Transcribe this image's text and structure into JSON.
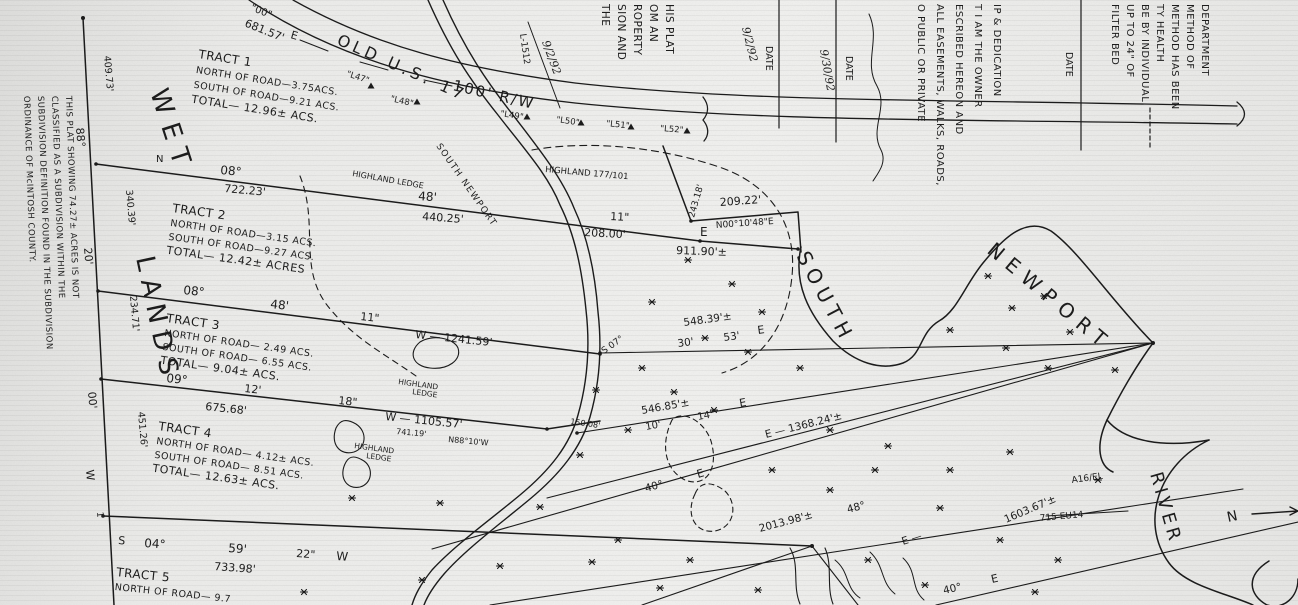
{
  "paper": {
    "ink_color": "#1b1b1b",
    "paper_color": "#ececea"
  },
  "road": {
    "name": "OLD U.S. 17",
    "right_of_way": "100' R/W"
  },
  "water": {
    "word_south": "SOUTH",
    "word_newport": "NEWPORT",
    "word_river": "RIVER"
  },
  "north_arrow_label": "N",
  "wetlands_label": {
    "word1": "WET",
    "word2": "LANDS"
  },
  "tracts": [
    {
      "lines": [
        "TRACT 1",
        "NORTH OF ROAD—3.75ACS.",
        "SOUTH OF ROAD—9.21 ACS.",
        "TOTAL— 12.96± ACS."
      ]
    },
    {
      "lines": [
        "TRACT 2",
        "NORTH OF ROAD—3.15 ACS.",
        "SOUTH OF ROAD—9.27 ACS.",
        "TOTAL— 12.42± ACRES"
      ]
    },
    {
      "lines": [
        "TRACT 3",
        "NORTH OF ROAD— 2.49 ACS.",
        "SOUTH OF ROAD— 6.55 ACS.",
        "TOTAL— 9.04± ACS."
      ]
    },
    {
      "lines": [
        "TRACT 4",
        "NORTH OF ROAD— 4.12± ACS.",
        "SOUTH OF ROAD— 8.51 ACS.",
        "TOTAL— 12.63± ACS."
      ]
    },
    {
      "lines": [
        "TRACT 5",
        "NORTH OF ROAD— 9.7"
      ]
    }
  ],
  "blocks": {
    "margin_note": {
      "lines": [
        "THIS PLAT SHOWING 74.27± ACRES IS NOT",
        "CLASSIFIED AS A SUBDIVISION WITHIN THE",
        "SUBDIVISION DEFINITION FOUND IN THE SUBDIVISION",
        "ORDINANCE OF McINTOSH COUNTY."
      ]
    },
    "surveyor_fragment": {
      "lines": [
        "HIS PLAT",
        "OM AN",
        "ROPERTY",
        "SION AND",
        "THE"
      ]
    },
    "dedication": {
      "lines": [
        "IP & DEDICATION",
        "T I AM THE OWNER",
        "ESCRIBED HEREON AND",
        "ALL EASEMENTS, WALKS, ROADS,",
        "O PUBLIC OR PRIVATE"
      ]
    },
    "health": {
      "lines": [
        "DEPARTMENT",
        "METHOD OF",
        "METHOD HAS BEEN",
        "TY HEALTH",
        "BE BY INDIVIDUAL",
        "UP TO 24\" OF",
        "FILTER BED"
      ]
    }
  },
  "map_labels": [
    {
      "n": "quote-00",
      "t": "\"00\"",
      "x": 250,
      "y": 10,
      "r": 22,
      "s": 10
    },
    {
      "n": "dist-681-57",
      "t": "681.57'",
      "x": 244,
      "y": 26,
      "r": 22,
      "s": 11
    },
    {
      "n": "bearing-e-road",
      "t": "E",
      "x": 290,
      "y": 38,
      "r": 16,
      "s": 11
    },
    {
      "n": "road-name",
      "t": "OLD U.S. 17",
      "x": 336,
      "y": 44,
      "r": 24,
      "s": 16,
      "sp": 4
    },
    {
      "n": "road-rw",
      "t": "100' R/W",
      "x": 452,
      "y": 90,
      "r": 13,
      "s": 15,
      "sp": 2
    },
    {
      "n": "station-l47",
      "t": "\"L47\"",
      "x": 346,
      "y": 76,
      "r": 18,
      "s": 8.5
    },
    {
      "n": "station-l48",
      "t": "\"L48\"",
      "x": 390,
      "y": 101,
      "r": 13,
      "s": 8.5
    },
    {
      "n": "station-l49",
      "t": "\"L49\"",
      "x": 500,
      "y": 116,
      "r": 9,
      "s": 8.5
    },
    {
      "n": "station-l50",
      "t": "\"L50\"",
      "x": 556,
      "y": 122,
      "r": 8,
      "s": 8.5
    },
    {
      "n": "station-l51",
      "t": "\"L51\"",
      "x": 606,
      "y": 126,
      "r": 6,
      "s": 8.5
    },
    {
      "n": "station-l52",
      "t": "\"L52\"",
      "x": 660,
      "y": 131,
      "r": 4,
      "s": 8.5
    },
    {
      "n": "note-highland-ledge",
      "t": "HIGHLAND LEDGE",
      "x": 352,
      "y": 176,
      "r": 10,
      "s": 8
    },
    {
      "n": "note-highland-deed",
      "t": "HIGHLAND 177/101",
      "x": 545,
      "y": 172,
      "r": 5,
      "s": 8.5
    },
    {
      "n": "creek-name",
      "t": "SOUTH NEWPORT",
      "x": 436,
      "y": 146,
      "r": 55,
      "s": 9,
      "sp": 1.5
    },
    {
      "n": "bearing-n",
      "t": "N",
      "x": 156,
      "y": 162,
      "r": 0,
      "s": 10
    },
    {
      "n": "bearing-08",
      "t": "08°",
      "x": 220,
      "y": 174,
      "r": 5,
      "s": 12
    },
    {
      "n": "dist-722-23",
      "t": "722.23'",
      "x": 224,
      "y": 192,
      "r": 5,
      "s": 11
    },
    {
      "n": "bearing-48",
      "t": "48'",
      "x": 418,
      "y": 200,
      "r": 4,
      "s": 12
    },
    {
      "n": "dist-440-25",
      "t": "440.25'",
      "x": 422,
      "y": 220,
      "r": 4,
      "s": 11
    },
    {
      "n": "bearing-11",
      "t": "11\"",
      "x": 610,
      "y": 220,
      "r": 3,
      "s": 11
    },
    {
      "n": "dist-208-00",
      "t": "208.00'",
      "x": 584,
      "y": 236,
      "r": 3,
      "s": 11
    },
    {
      "n": "bearing-e1",
      "t": "E",
      "x": 700,
      "y": 236,
      "r": 0,
      "s": 12
    },
    {
      "n": "dist-911-90",
      "t": "911.90'±",
      "x": 676,
      "y": 254,
      "r": 2,
      "s": 11
    },
    {
      "n": "dist-209-22",
      "t": "209.22'",
      "x": 720,
      "y": 206,
      "r": -4,
      "s": 11
    },
    {
      "n": "bearing-n00",
      "t": "N00°10'48\"E",
      "x": 716,
      "y": 228,
      "r": -4,
      "s": 9
    },
    {
      "n": "dist-243-18",
      "t": "243.18'",
      "x": 694,
      "y": 218,
      "r": -74,
      "s": 9
    },
    {
      "n": "bearing-08b",
      "t": "08°",
      "x": 183,
      "y": 294,
      "r": 6,
      "s": 12
    },
    {
      "n": "bearing-48b",
      "t": "48'",
      "x": 270,
      "y": 308,
      "r": 6,
      "s": 12
    },
    {
      "n": "bearing-11b",
      "t": "11\"",
      "x": 360,
      "y": 320,
      "r": 6,
      "s": 11
    },
    {
      "n": "dist-1241-59",
      "t": "W — 1241.59'",
      "x": 415,
      "y": 338,
      "r": 6,
      "s": 11
    },
    {
      "n": "bearing-09",
      "t": "09°",
      "x": 166,
      "y": 382,
      "r": 6,
      "s": 12
    },
    {
      "n": "bearing-12",
      "t": "12'",
      "x": 244,
      "y": 392,
      "r": 6,
      "s": 11
    },
    {
      "n": "dist-675-68",
      "t": "675.68'",
      "x": 205,
      "y": 410,
      "r": 6,
      "s": 11
    },
    {
      "n": "bearing-18",
      "t": "18\"",
      "x": 338,
      "y": 404,
      "r": 6,
      "s": 11
    },
    {
      "n": "dist-1105-57",
      "t": "W — 1105.57'",
      "x": 385,
      "y": 420,
      "r": 6,
      "s": 11
    },
    {
      "n": "dist-741-19",
      "t": "741.19'",
      "x": 396,
      "y": 434,
      "r": 5,
      "s": 8
    },
    {
      "n": "bearing-n88",
      "t": "N88°10'W",
      "x": 448,
      "y": 442,
      "r": 5,
      "s": 8
    },
    {
      "n": "dist-150-08",
      "t": "150.08'",
      "x": 570,
      "y": 424,
      "r": 8,
      "s": 8
    },
    {
      "n": "bearing-s",
      "t": "S",
      "x": 118,
      "y": 544,
      "r": 4,
      "s": 11
    },
    {
      "n": "bearing-04",
      "t": "04°",
      "x": 144,
      "y": 547,
      "r": 4,
      "s": 12
    },
    {
      "n": "bearing-59",
      "t": "59'",
      "x": 228,
      "y": 552,
      "r": 4,
      "s": 12
    },
    {
      "n": "bearing-22",
      "t": "22\"",
      "x": 296,
      "y": 557,
      "r": 4,
      "s": 11
    },
    {
      "n": "bearing-w",
      "t": "W",
      "x": 336,
      "y": 560,
      "r": 4,
      "s": 12
    },
    {
      "n": "dist-733-98",
      "t": "733.98'",
      "x": 214,
      "y": 570,
      "r": 4,
      "s": 11
    },
    {
      "n": "bdy-88",
      "t": "88°",
      "x": 76,
      "y": 128,
      "r": 85,
      "s": 11
    },
    {
      "n": "bdy-409-73",
      "t": "409.73'",
      "x": 104,
      "y": 56,
      "r": 85,
      "s": 9.5
    },
    {
      "n": "bdy-20",
      "t": "20'",
      "x": 84,
      "y": 248,
      "r": 85,
      "s": 11
    },
    {
      "n": "bdy-340-39",
      "t": "340.39'",
      "x": 126,
      "y": 190,
      "r": 85,
      "s": 9.5
    },
    {
      "n": "bdy-234-71",
      "t": "234.71'",
      "x": 130,
      "y": 296,
      "r": 85,
      "s": 9.5
    },
    {
      "n": "bdy-00",
      "t": "00'",
      "x": 88,
      "y": 392,
      "r": 85,
      "s": 11
    },
    {
      "n": "bdy-451-26",
      "t": "451.26'",
      "x": 138,
      "y": 412,
      "r": 85,
      "s": 9.5
    },
    {
      "n": "bdy-w",
      "t": "W",
      "x": 86,
      "y": 470,
      "r": 85,
      "s": 11
    },
    {
      "n": "bdy-1",
      "t": "1",
      "x": 97,
      "y": 512,
      "r": 85,
      "s": 9
    },
    {
      "n": "wetlands-wet",
      "t": "WET",
      "x": 150,
      "y": 92,
      "r": 72,
      "s": 26,
      "sp": 10
    },
    {
      "n": "wetlands-lands",
      "t": "LANDS",
      "x": 136,
      "y": 258,
      "r": 78,
      "s": 26,
      "sp": 8
    },
    {
      "n": "bearing-s07",
      "t": "S 07°",
      "x": 604,
      "y": 354,
      "r": -35,
      "s": 9
    },
    {
      "n": "dist-548-39",
      "t": "548.39'±",
      "x": 684,
      "y": 326,
      "r": -8,
      "s": 10.5
    },
    {
      "n": "bearing-30",
      "t": "30'",
      "x": 678,
      "y": 347,
      "r": -8,
      "s": 10.5
    },
    {
      "n": "bearing-53",
      "t": "53'",
      "x": 724,
      "y": 341,
      "r": -8,
      "s": 10.5
    },
    {
      "n": "bearing-e2",
      "t": "E",
      "x": 758,
      "y": 334,
      "r": -8,
      "s": 11
    },
    {
      "n": "dist-546-85",
      "t": "546.85'±",
      "x": 642,
      "y": 414,
      "r": -10,
      "s": 10.5
    },
    {
      "n": "bearing-10",
      "t": "10'",
      "x": 646,
      "y": 430,
      "r": -10,
      "s": 10
    },
    {
      "n": "bearing-14",
      "t": "14\"",
      "x": 698,
      "y": 420,
      "r": -10,
      "s": 10
    },
    {
      "n": "bearing-e3",
      "t": "E",
      "x": 740,
      "y": 407,
      "r": -10,
      "s": 11
    },
    {
      "n": "dist-1368-24",
      "t": "E — 1368.24'±",
      "x": 766,
      "y": 438,
      "r": -14,
      "s": 10.5
    },
    {
      "n": "bearing-40a",
      "t": "40°",
      "x": 646,
      "y": 492,
      "r": -16,
      "s": 10.5
    },
    {
      "n": "bearing-e4",
      "t": "E",
      "x": 698,
      "y": 478,
      "r": -16,
      "s": 11
    },
    {
      "n": "dist-2013-98",
      "t": "2013.98'±",
      "x": 760,
      "y": 532,
      "r": -15,
      "s": 10.5
    },
    {
      "n": "bearing-48c",
      "t": "48°",
      "x": 848,
      "y": 513,
      "r": -15,
      "s": 10.5
    },
    {
      "n": "bearing-e5",
      "t": "E —",
      "x": 903,
      "y": 545,
      "r": -18,
      "s": 10.5
    },
    {
      "n": "dist-1603-67",
      "t": "1603.67'±",
      "x": 1006,
      "y": 523,
      "r": -23,
      "s": 10.5
    },
    {
      "n": "note-a16-el",
      "t": "A16/EL",
      "x": 1072,
      "y": 483,
      "r": -8,
      "s": 9
    },
    {
      "n": "note-715-eu14",
      "t": "715 EU14",
      "x": 1040,
      "y": 521,
      "r": -5,
      "s": 9
    },
    {
      "n": "bearing-40b",
      "t": "40°",
      "x": 944,
      "y": 594,
      "r": -13,
      "s": 10.5
    },
    {
      "n": "bearing-e6",
      "t": "E",
      "x": 992,
      "y": 583,
      "r": -13,
      "s": 11
    },
    {
      "n": "river-south",
      "t": "SOUTH",
      "x": 796,
      "y": 256,
      "r": 62,
      "s": 20,
      "sp": 6
    },
    {
      "n": "river-newport",
      "t": "NEWPORT",
      "x": 986,
      "y": 252,
      "r": 40,
      "s": 20,
      "sp": 8
    },
    {
      "n": "river-river",
      "t": "RIVER",
      "x": 1150,
      "y": 474,
      "r": 74,
      "s": 18,
      "sp": 4
    },
    {
      "n": "north-arrow-label",
      "t": "N",
      "x": 1228,
      "y": 522,
      "r": -12,
      "s": 14
    },
    {
      "n": "note-highland-a",
      "t": "HIGHLAND",
      "x": 398,
      "y": 384,
      "r": 8,
      "s": 7.5
    },
    {
      "n": "note-ledge-a",
      "t": "LEDGE",
      "x": 412,
      "y": 394,
      "r": 8,
      "s": 7.5
    },
    {
      "n": "note-highland-b",
      "t": "HIGHLAND",
      "x": 354,
      "y": 448,
      "r": 8,
      "s": 7.5
    },
    {
      "n": "note-ledge-b",
      "t": "LEDGE",
      "x": 366,
      "y": 458,
      "r": 8,
      "s": 7.5
    },
    {
      "n": "date-hand-1",
      "t": "9/2/92",
      "x": 542,
      "y": 42,
      "r": 70,
      "s": 11,
      "h": 1
    },
    {
      "n": "surveyor-no",
      "t": "L-1512",
      "x": 520,
      "y": 34,
      "r": 82,
      "s": 9
    },
    {
      "n": "date-hand-2",
      "t": "9/2/92",
      "x": 742,
      "y": 28,
      "r": 76,
      "s": 11,
      "h": 1
    },
    {
      "n": "date-label-1",
      "t": "DATE",
      "x": 766,
      "y": 46,
      "r": 90,
      "s": 9.5
    },
    {
      "n": "date-hand-3",
      "t": "9/30/92",
      "x": 820,
      "y": 50,
      "r": 80,
      "s": 11,
      "h": 1
    },
    {
      "n": "date-label-2",
      "t": "DATE",
      "x": 846,
      "y": 56,
      "r": 90,
      "s": 9.5
    },
    {
      "n": "date-label-3",
      "t": "DATE",
      "x": 1066,
      "y": 52,
      "r": 90,
      "s": 9.5
    }
  ]
}
